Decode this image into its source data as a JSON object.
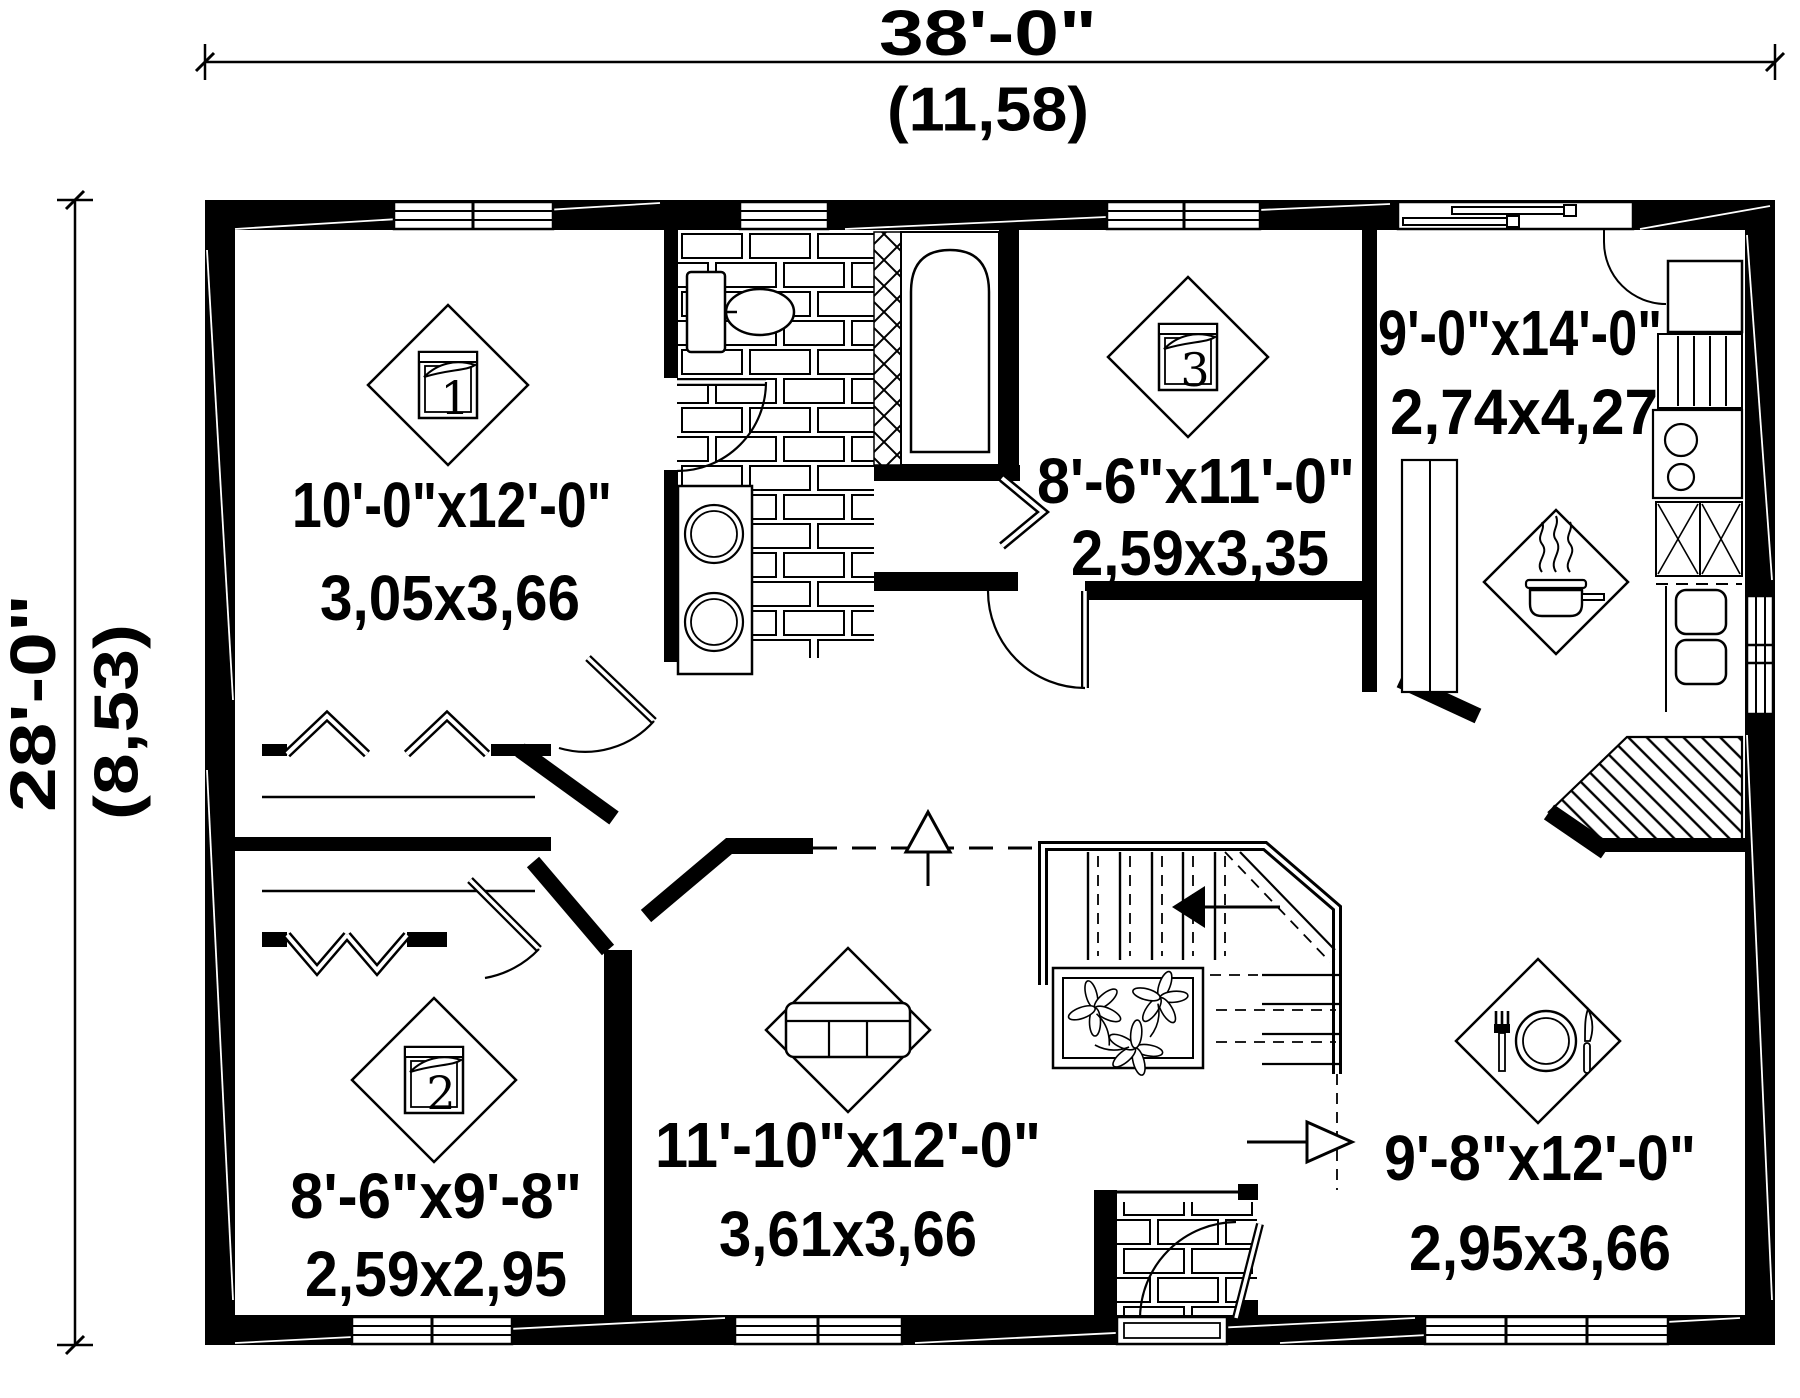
{
  "plan": {
    "title": "house-first-floor-plan",
    "accent_color": "#000000",
    "background_color": "#ffffff",
    "overall": {
      "width_imperial": "38'-0\"",
      "width_metric": "(11,58)",
      "depth_imperial": "28'-0\"",
      "depth_metric": "(8,53)"
    },
    "rooms": {
      "bedroom1": {
        "number": "1",
        "imperial": "10'-0\"x12'-0\"",
        "metric": "3,05x3,66"
      },
      "bedroom2": {
        "number": "2",
        "imperial": "8'-6\"x9'-8\"",
        "metric": "2,59x2,95"
      },
      "bedroom3": {
        "number": "3",
        "imperial": "8'-6\"x11'-0\"",
        "metric": "2,59x3,35"
      },
      "kitchen": {
        "imperial": "9'-0\"x14'-0\"",
        "metric": "2,74x4,27"
      },
      "living": {
        "imperial": "11'-10\"x12'-0\"",
        "metric": "3,61x3,66"
      },
      "dining": {
        "imperial": "9'-8\"x12'-0\"",
        "metric": "2,95x3,66"
      }
    },
    "icons": [
      "bed-icon-1",
      "bed-icon-2",
      "bed-icon-3",
      "sofa-icon",
      "cooking-pot-icon",
      "dining-plate-icon",
      "bathtub-icon",
      "toilet-icon",
      "double-sink-vanity-icon",
      "kitchen-sink-icon",
      "stove-icon",
      "fridge-icon",
      "stairs-icon",
      "planter-icon",
      "entry-arrow-icon"
    ]
  }
}
